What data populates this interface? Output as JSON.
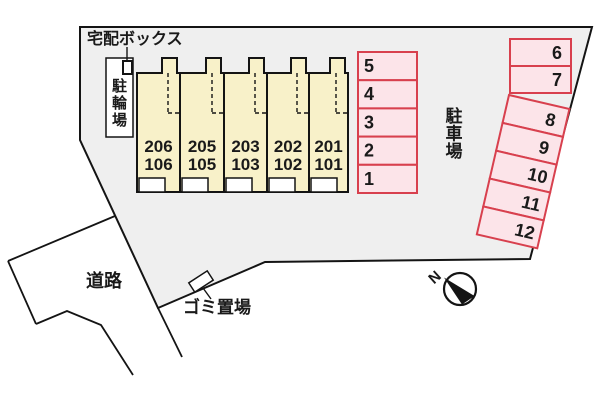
{
  "labels": {
    "delivery_box": "宅配ボックス",
    "bicycle_parking": "駐輪場",
    "parking_lot": "駐車場",
    "road": "道路",
    "garbage_area": "ゴミ置場",
    "north_mark": "N"
  },
  "building": {
    "units": [
      {
        "upper": "206",
        "lower": "106"
      },
      {
        "upper": "205",
        "lower": "105"
      },
      {
        "upper": "203",
        "lower": "103"
      },
      {
        "upper": "202",
        "lower": "102"
      },
      {
        "upper": "201",
        "lower": "101"
      }
    ]
  },
  "parking": {
    "left_column_stalls": [
      "5",
      "4",
      "3",
      "2",
      "1"
    ],
    "top_right_stalls": [
      "6",
      "7"
    ],
    "right_column_stalls": [
      "8",
      "9",
      "10",
      "11",
      "12"
    ]
  },
  "colors": {
    "site_fill": "#efefef",
    "building_fill": "#f8f1c9",
    "stall_fill": "#fce4e9",
    "stall_border": "#d8404e",
    "line": "#141414",
    "text": "#1a1a1a"
  }
}
